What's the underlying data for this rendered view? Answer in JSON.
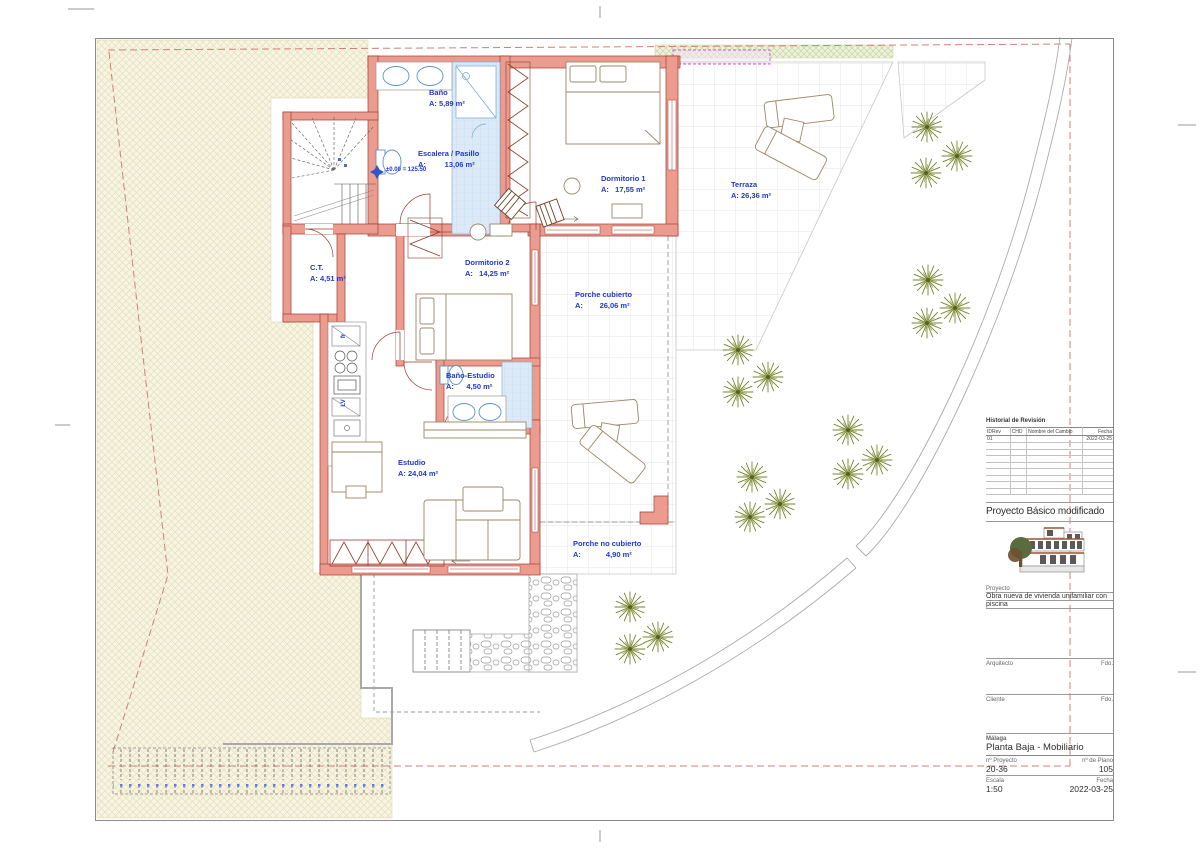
{
  "plan": {
    "rooms": [
      {
        "name": "Baño",
        "area": "A: 5,89 m²"
      },
      {
        "name": "Escalera / Pasillo",
        "area": "A:         13,06 m²"
      },
      {
        "name": "Dormitorio 1",
        "area": "A:   17,55 m²"
      },
      {
        "name": "Terraza",
        "area": "A: 26,36 m²"
      },
      {
        "name": "C.T.",
        "area": "A: 4,51 m²"
      },
      {
        "name": "Dormitorio 2",
        "area": "A:   14,25 m²"
      },
      {
        "name": "Porche cubierto",
        "area": "A:        26,06 m²"
      },
      {
        "name": "Baño-Estudio",
        "area": "A:      4,50 m²"
      },
      {
        "name": "Estudio",
        "area": "A: 24,04 m²"
      },
      {
        "name": "Porche no cubierto",
        "area": "A:            4,90 m²"
      }
    ],
    "level_marker": "±0.00 = 125.50",
    "kitchen": {
      "fridge": "fr",
      "dishwasher": "LV"
    }
  },
  "titleblock": {
    "revision": {
      "title": "Historial de Revisión",
      "headers": [
        "IDRev",
        "CHD",
        "Nombre del Cambio",
        "Fecha"
      ],
      "rows": [
        [
          "01",
          "",
          "",
          "2022-03-25"
        ]
      ]
    },
    "project_title": "Proyecto Básico modificado",
    "project_label": "Proyecto",
    "project_desc_line1": "Obra nueva de vivienda unifamiliar con",
    "project_desc_line2": "piscina",
    "architect_label": "Arquitecto",
    "client_label": "Cliente",
    "signature_label": "Fdo.",
    "city": "Málaga",
    "sheet_name": "Planta Baja - Mobiliario",
    "project_no_label": "nº Proyecto",
    "plan_no_label": "nº de Plano",
    "project_no": "20-36",
    "plan_no": "105",
    "scale_label": "Escala",
    "date_label": "Fecha",
    "scale": "1:50",
    "date": "2022-03-25"
  },
  "colors": {
    "label_blue": "#2038C8",
    "wall_fill": "#EC9C8F",
    "wall_stroke": "#A23B33",
    "boundary_dash": "#D08274",
    "tree_green": "#71862F",
    "hatch_bg": "#F7F4E3"
  }
}
